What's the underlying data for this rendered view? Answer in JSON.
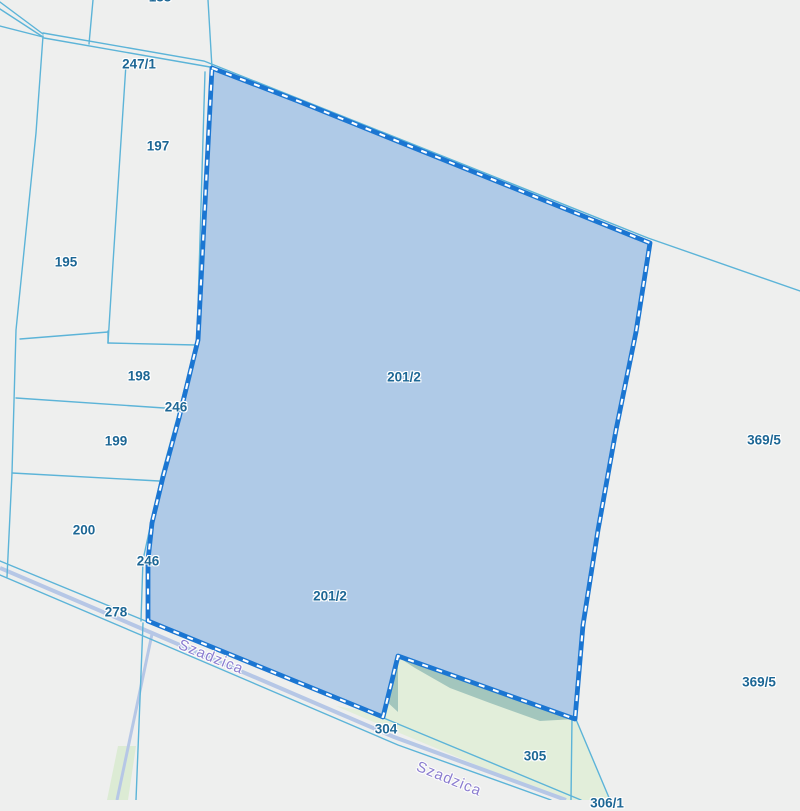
{
  "map": {
    "type": "cadastral-parcel-map",
    "selected_parcel": {
      "id": "201/2",
      "fill_color": "#a9c7e6",
      "border_color": "#1b76d2",
      "border_dash_color": "#ffffff"
    },
    "street": {
      "name": "Szadzica",
      "label_color": "#8b7dd0"
    },
    "colors": {
      "background": "#eeefee",
      "boundary_line": "#5cb4d8",
      "road_line": "#b6c7e6",
      "green_area": "#e2eeda",
      "green_dark_area": "#a3c6bd",
      "parcel_label": "#1d6795"
    },
    "parcel_labels": [
      {
        "text": "247/1",
        "note": "road parcel, top"
      },
      {
        "text": "197"
      },
      {
        "text": "195"
      },
      {
        "text": "198"
      },
      {
        "text": "246",
        "note": "road strip, upper label"
      },
      {
        "text": "199"
      },
      {
        "text": "200"
      },
      {
        "text": "246",
        "note": "road strip, lower label"
      },
      {
        "text": "278"
      },
      {
        "text": "201/2",
        "note": "selected parcel, upper label"
      },
      {
        "text": "201/2",
        "note": "selected parcel, lower label"
      },
      {
        "text": "369/5",
        "note": "right side, upper label"
      },
      {
        "text": "369/5",
        "note": "right side, lower label"
      },
      {
        "text": "304"
      },
      {
        "text": "305"
      },
      {
        "text": "188",
        "note": "partially visible, clipped at top edge"
      },
      {
        "text": "306/1",
        "note": "partially visible, clipped at bottom edge"
      }
    ],
    "street_labels": [
      {
        "text": "Szadzica",
        "note": "upper occurrence"
      },
      {
        "text": "Szadzica",
        "note": "lower occurrence"
      }
    ]
  }
}
